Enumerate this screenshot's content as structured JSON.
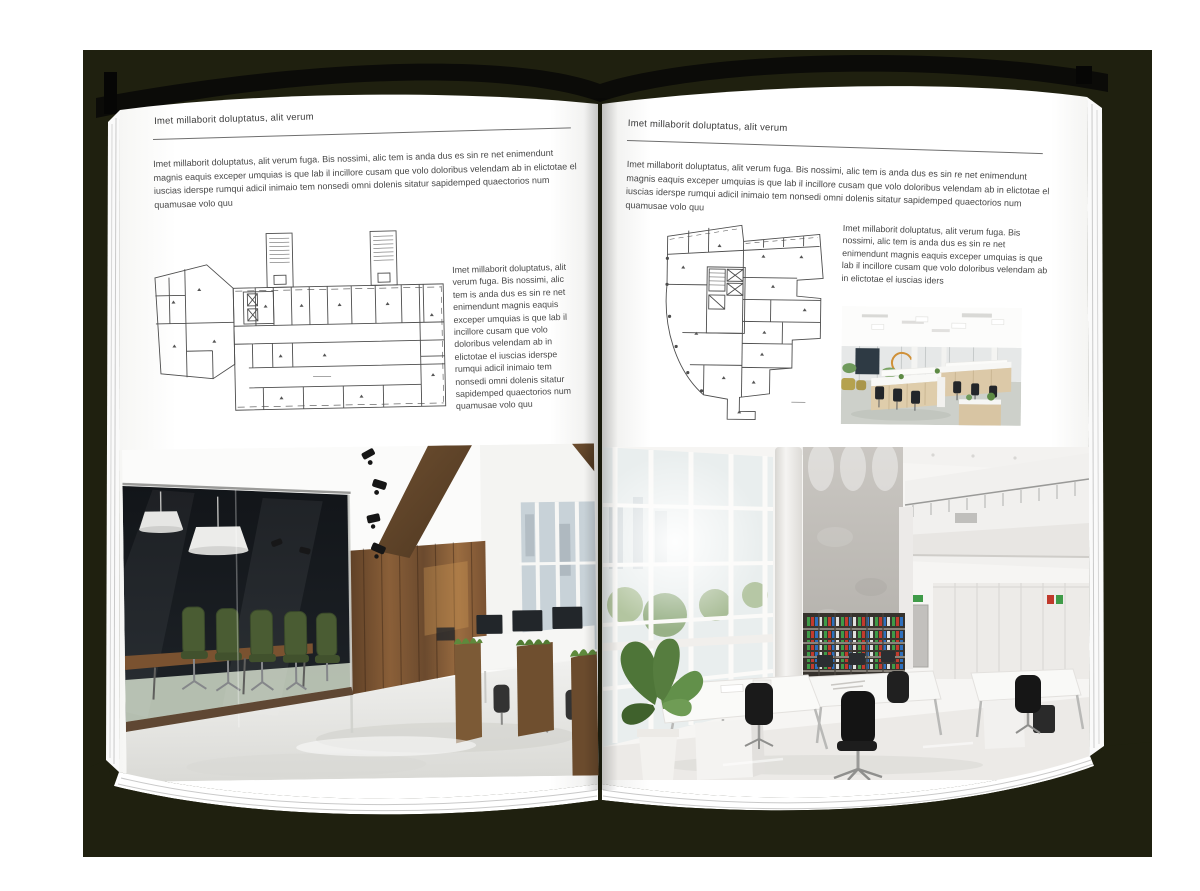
{
  "colors": {
    "backdrop": "#1f200f",
    "page": "#ffffff",
    "text": "#454545",
    "rule": "#6f6f6f",
    "plan_lines": "#4d4d4d"
  },
  "left_page": {
    "header": "Imet millaborit doluptatus, alit verum",
    "intro": "Imet millaborit doluptatus, alit verum fuga. Bis nossimi, alic tem is anda dus es sin re net enimendunt magnis eaquis exceper umquias is que lab il incillore cusam que volo doloribus velendam ab in elictotae el iuscias iderspe rumqui adicil inimaio tem nonsedi omni dolenis sitatur sapidemped quaectorios num quamusae volo quu",
    "side_text": "Imet millaborit doluptatus, alit verum fuga. Bis nossimi, alic tem is anda dus es sin re net enimendunt magnis eaquis exceper umquias is que lab il incillore cusam que volo doloribus velendam ab in elictotae el iuscias iderspe rumqui adicil inimaio tem nonsedi omni dolenis sitatur sapidemped quaectorios num quamusae volo quu",
    "floor_plan_label": "floor plan drawing with two stair towers and angled left annex",
    "photo_label": "loft office interior with glass meeting room, green chairs, wooden wall and desks"
  },
  "right_page": {
    "header": "Imet millaborit doluptatus, alit verum",
    "intro": "Imet millaborit doluptatus, alit verum fuga. Bis nossimi, alic tem is anda dus es sin re net enimendunt magnis eaquis exceper umquias is que lab il incillore cusam que volo doloribus velendam ab in elictotae el iuscias iderspe rumqui adicil inimaio tem nonsedi omni dolenis sitatur sapidemped quaectorios num quamusae volo quu",
    "side_text": "Imet millaborit doluptatus, alit verum fuga. Bis nossimi, alic tem is anda dus es sin re net enimendunt magnis eaquis exceper umquias is que lab il incillore cusam que volo doloribus velendam ab in elictotae el iuscias iders",
    "floor_plan_label": "irregular floor plan drawing with curved left facade",
    "photo_small_label": "open plan office with light wood desks and black chairs",
    "photo_large_label": "double-height white office with bookshelves, large windows and white desks"
  }
}
